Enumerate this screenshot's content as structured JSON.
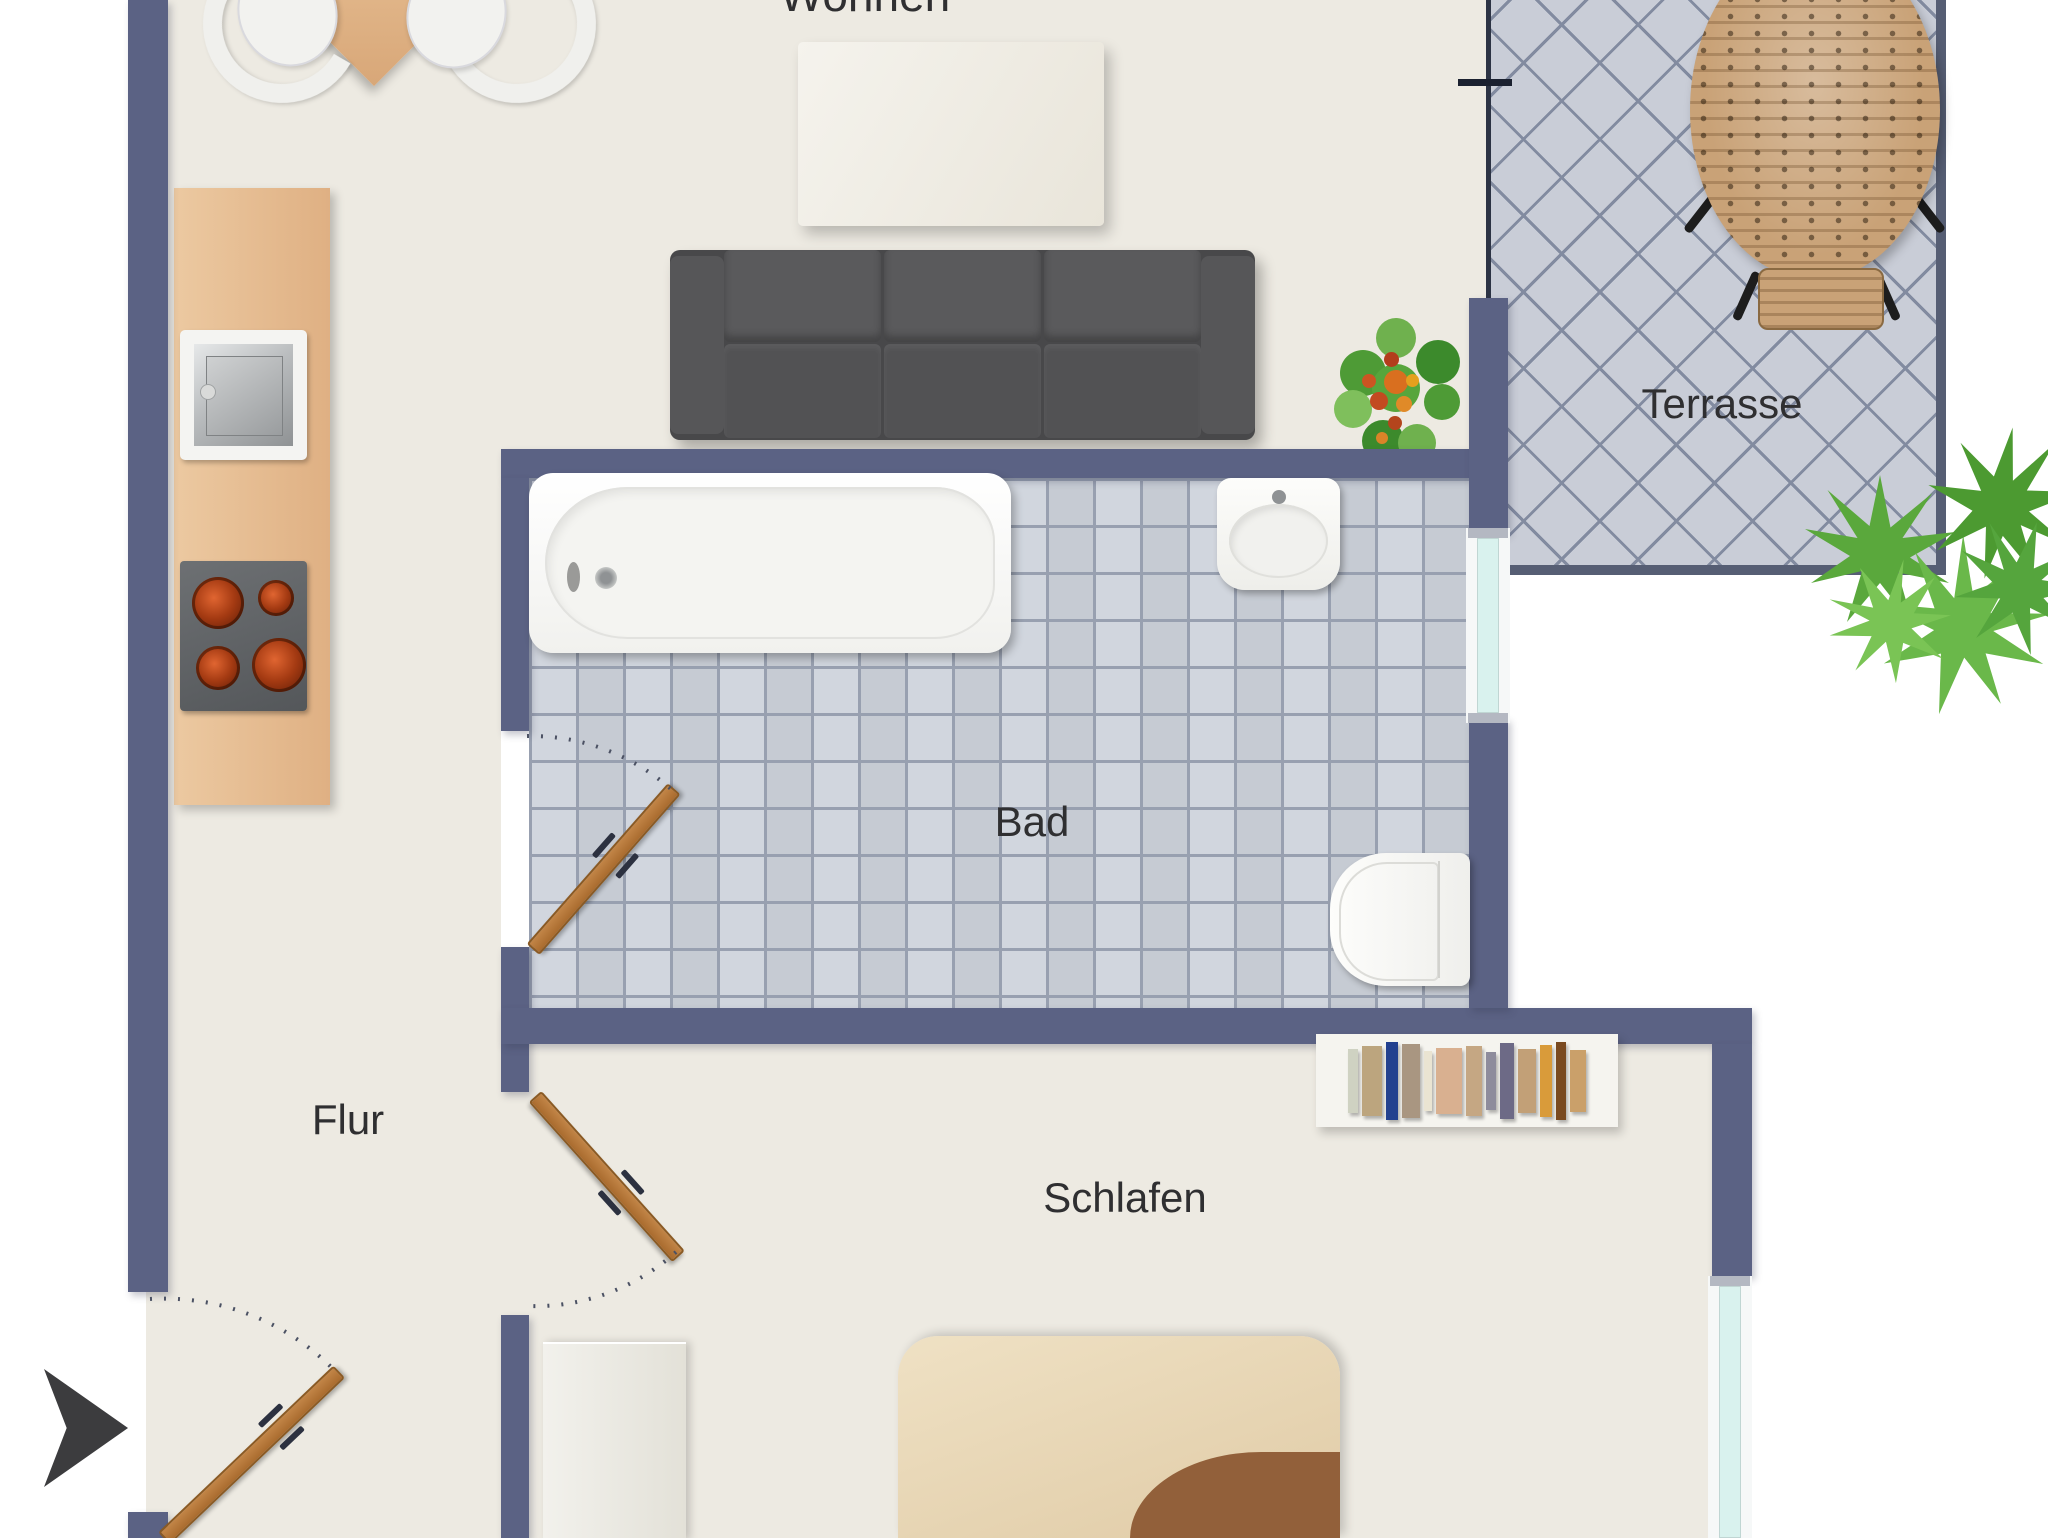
{
  "labels": {
    "wohnen": "Wohnen",
    "terrasse": "Terrasse",
    "bad": "Bad",
    "flur": "Flur",
    "schlafen": "Schlafen"
  },
  "colors": {
    "wall": "#5b6284",
    "floor": "#edeae2",
    "bath_tile": "#ced3dc",
    "bath_grout": "#98a0b0",
    "terr_tile": "#c9cdd7",
    "terr_grout": "#828ba0",
    "door_wood": "#b5793b",
    "door_wood_dark": "#8a5a24",
    "counter": "#ecc9a1",
    "counter_dark": "#dfb083",
    "sofa": "#48484a",
    "sofa_light": "#565658",
    "glass": "#d9f2ee",
    "frame": "#f6f8f8",
    "blanket": "#92603a",
    "shelf": "#f5f4ef",
    "arrow": "#3c3c3e",
    "label": "#2f2f31",
    "chair_tan": "#c9a277"
  },
  "bookshelf": {
    "spines": [
      {
        "w": 10,
        "h": 64,
        "c": "#cfd2c2"
      },
      {
        "w": 20,
        "h": 70,
        "c": "#bca57e"
      },
      {
        "w": 12,
        "h": 78,
        "c": "#23418f"
      },
      {
        "w": 18,
        "h": 74,
        "c": "#a99681"
      },
      {
        "w": 8,
        "h": 60,
        "c": "#eae4d2"
      },
      {
        "w": 26,
        "h": 66,
        "c": "#d9b090"
      },
      {
        "w": 16,
        "h": 70,
        "c": "#c5a783"
      },
      {
        "w": 10,
        "h": 58,
        "c": "#8e8c9c"
      },
      {
        "w": 14,
        "h": 76,
        "c": "#6d6a86"
      },
      {
        "w": 18,
        "h": 64,
        "c": "#c2a077"
      },
      {
        "w": 12,
        "h": 72,
        "c": "#d99b3a"
      },
      {
        "w": 10,
        "h": 78,
        "c": "#7a4a20"
      },
      {
        "w": 16,
        "h": 62,
        "c": "#caa06a"
      }
    ]
  },
  "flower_plant": {
    "greens": [
      {
        "x": 8,
        "y": 38,
        "s": 46,
        "c": "#4e9b36"
      },
      {
        "x": 44,
        "y": 6,
        "s": 40,
        "c": "#6fb14e"
      },
      {
        "x": 84,
        "y": 28,
        "s": 44,
        "c": "#3c8a2c"
      },
      {
        "x": 2,
        "y": 78,
        "s": 38,
        "c": "#7fbf5c"
      },
      {
        "x": 92,
        "y": 72,
        "s": 36,
        "c": "#4e9b36"
      },
      {
        "x": 30,
        "y": 108,
        "s": 42,
        "c": "#3c8a2c"
      },
      {
        "x": 66,
        "y": 112,
        "s": 38,
        "c": "#6fb14e"
      },
      {
        "x": 40,
        "y": 52,
        "s": 48,
        "c": "#57a53c"
      }
    ],
    "accents": [
      {
        "x": 52,
        "y": 58,
        "s": 24,
        "c": "#d96f1f"
      },
      {
        "x": 38,
        "y": 80,
        "s": 18,
        "c": "#c24a20"
      },
      {
        "x": 64,
        "y": 84,
        "s": 16,
        "c": "#e08a28"
      },
      {
        "x": 52,
        "y": 40,
        "s": 15,
        "c": "#b33d1c"
      },
      {
        "x": 74,
        "y": 62,
        "s": 13,
        "c": "#e5a01e"
      },
      {
        "x": 30,
        "y": 62,
        "s": 14,
        "c": "#cc5522"
      },
      {
        "x": 56,
        "y": 104,
        "s": 14,
        "c": "#b4451d"
      },
      {
        "x": 44,
        "y": 120,
        "s": 12,
        "c": "#d98428"
      }
    ]
  },
  "palm_plant": {
    "fronds": [
      {
        "x": 1805,
        "y": 475,
        "s": 150,
        "r": 0,
        "c": "#5aa83c"
      },
      {
        "x": 1880,
        "y": 540,
        "s": 170,
        "r": 40,
        "c": "#6ab84a"
      },
      {
        "x": 1930,
        "y": 430,
        "s": 150,
        "r": 80,
        "c": "#4c9a31"
      },
      {
        "x": 1830,
        "y": 560,
        "s": 120,
        "r": -30,
        "c": "#7ac455"
      },
      {
        "x": 1955,
        "y": 520,
        "s": 130,
        "r": 15,
        "c": "#55a53d"
      }
    ]
  }
}
